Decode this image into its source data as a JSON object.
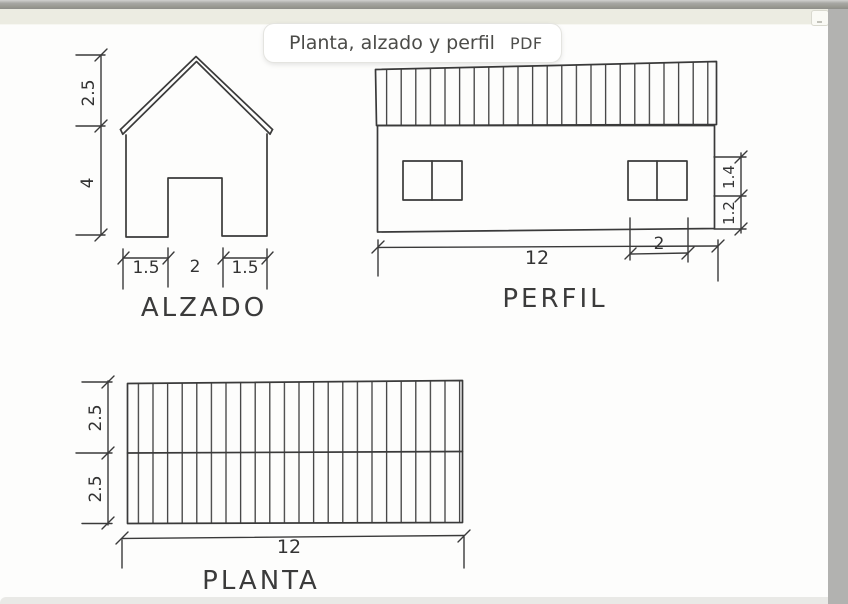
{
  "header": {
    "pill_title": "Planta, alzado y perfil",
    "pill_badge": "PDF"
  },
  "colors": {
    "ink": "#3a3a3a",
    "paper": "#fdfdfc",
    "margin_gray": "#b2b2b0",
    "paper_edge": "#ecece2",
    "pill_text": "#4b4b48"
  },
  "views": {
    "alzado": {
      "label": "ALZADO",
      "roof_height": "2.5",
      "wall_height": "4",
      "door_left": "1.5",
      "door_width": "2",
      "door_right": "1.5"
    },
    "perfil": {
      "label": "PERFIL",
      "length": "12",
      "window_width": "2",
      "window_height": "1.4",
      "sill_height": "1.2"
    },
    "planta": {
      "label": "PLANTA",
      "depth_back": "2.5",
      "depth_front": "2.5",
      "length": "12"
    }
  }
}
